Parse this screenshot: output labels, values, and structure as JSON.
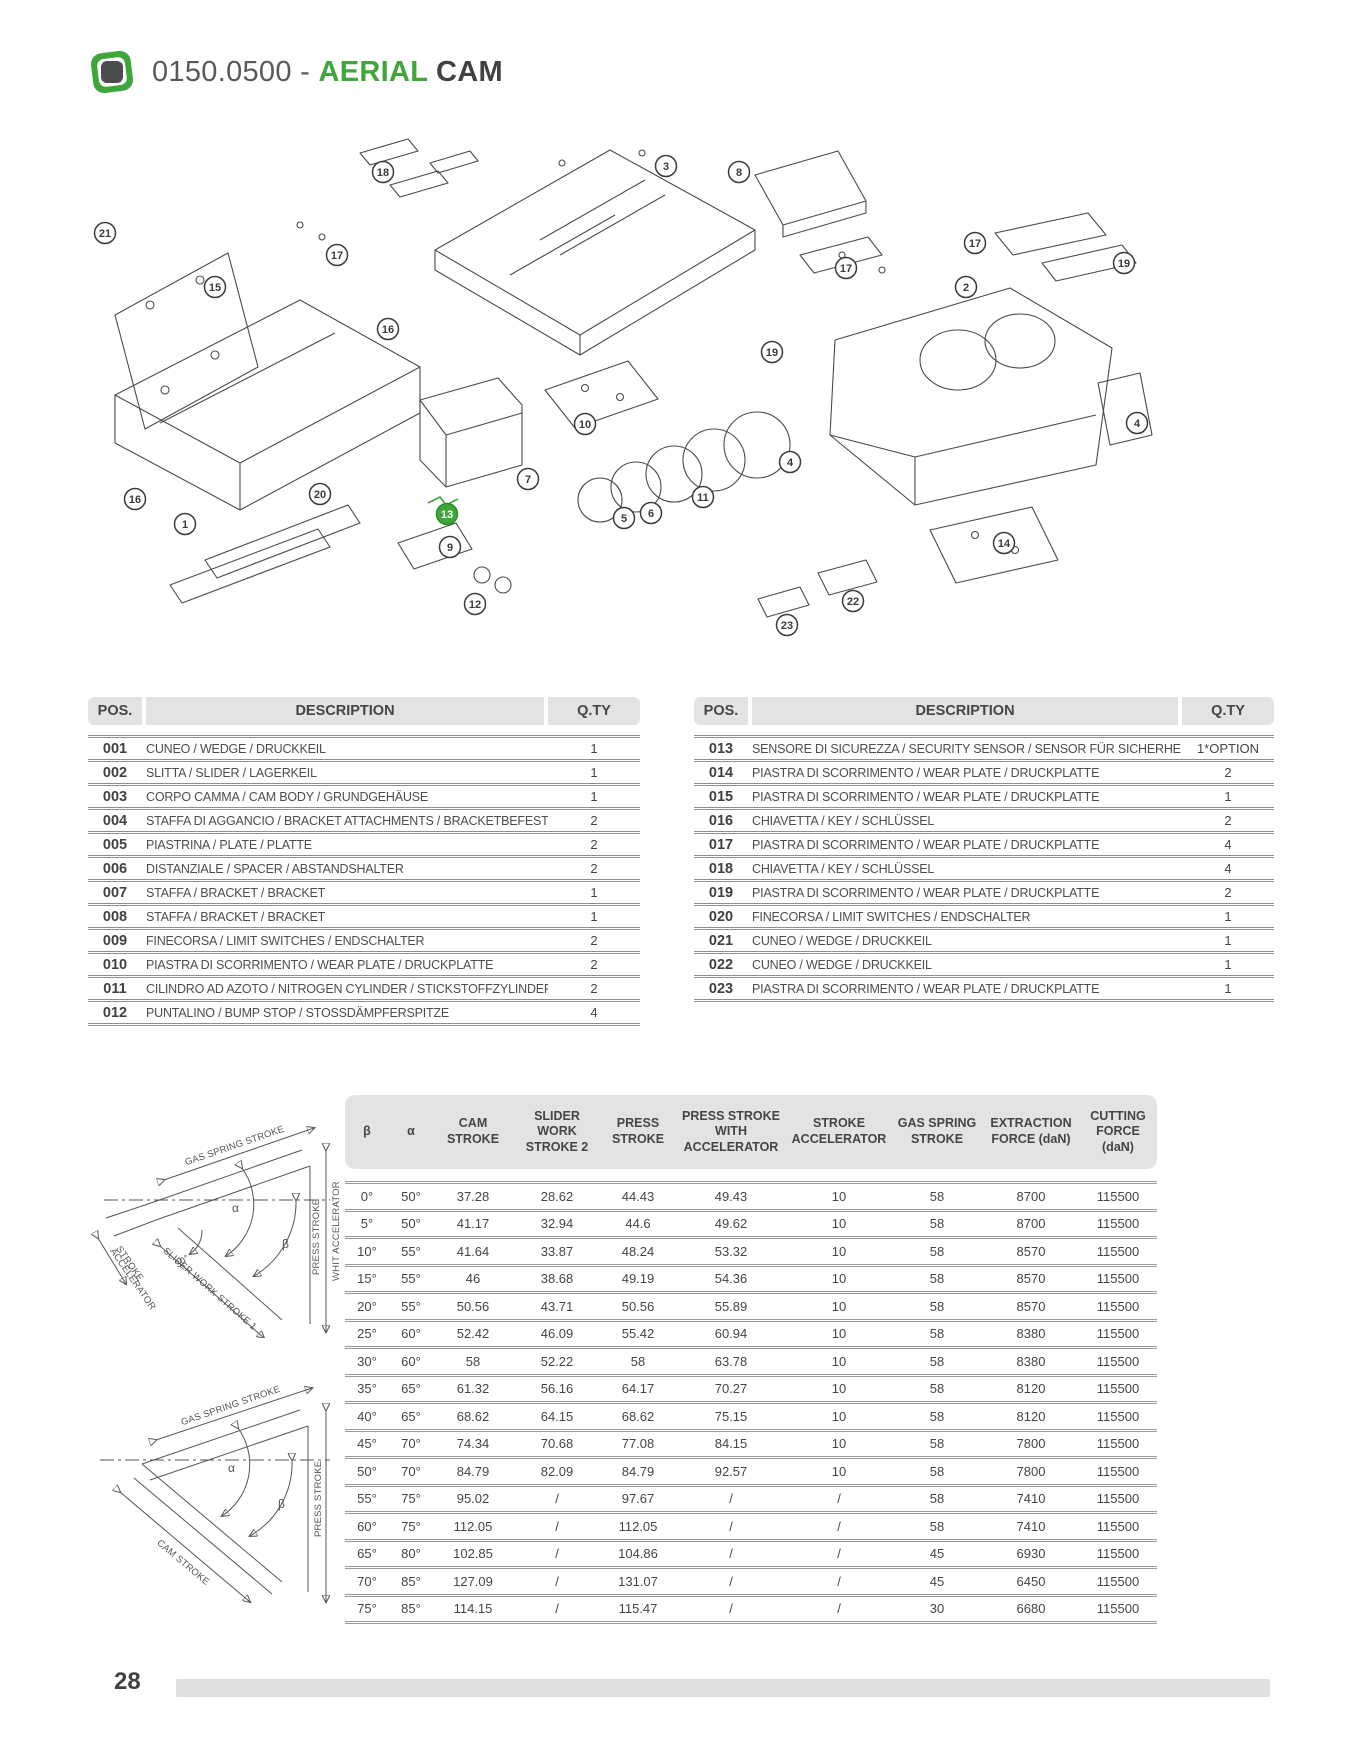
{
  "page": {
    "number": "28"
  },
  "header": {
    "code": "0150.0500 - ",
    "title_accent": "AERIAL",
    "title_rest": " CAM"
  },
  "colors": {
    "accent_green": "#3ea63b",
    "dark_text": "#414042",
    "table_header_bg": "#e3e3e3",
    "separator_line": "#8f8f8f"
  },
  "parts_table": {
    "pos_header": "POS.",
    "description_header": "DESCRIPTION",
    "qty_header": "Q.TY",
    "left_rows": [
      {
        "pos": "001",
        "description": "CUNEO / WEDGE / DRUCKKEIL",
        "qty": "1"
      },
      {
        "pos": "002",
        "description": "SLITTA / SLIDER / LAGERKEIL",
        "qty": "1"
      },
      {
        "pos": "003",
        "description": "CORPO CAMMA / CAM BODY / GRUNDGEHÄUSE",
        "qty": "1"
      },
      {
        "pos": "004",
        "description": "STAFFA DI AGGANCIO / BRACKET ATTACHMENTS / BRACKETBEFESTIGUNG",
        "qty": "2"
      },
      {
        "pos": "005",
        "description": "PIASTRINA / PLATE / PLATTE",
        "qty": "2"
      },
      {
        "pos": "006",
        "description": "DISTANZIALE / SPACER / ABSTANDSHALTER",
        "qty": "2"
      },
      {
        "pos": "007",
        "description": "STAFFA / BRACKET / BRACKET",
        "qty": "1"
      },
      {
        "pos": "008",
        "description": "STAFFA / BRACKET / BRACKET",
        "qty": "1"
      },
      {
        "pos": "009",
        "description": "FINECORSA / LIMIT SWITCHES / ENDSCHALTER",
        "qty": "2"
      },
      {
        "pos": "010",
        "description": "PIASTRA DI SCORRIMENTO / WEAR PLATE / DRUCKPLATTE",
        "qty": "2"
      },
      {
        "pos": "011",
        "description": "CILINDRO AD AZOTO / NITROGEN CYLINDER / STICKSTOFFZYLINDER",
        "qty": "2"
      },
      {
        "pos": "012",
        "description": "PUNTALINO / BUMP STOP / STOSSDÄMPFERSPITZE",
        "qty": "4"
      }
    ],
    "right_rows": [
      {
        "pos": "013",
        "description": "SENSORE DI SICUREZZA / SECURITY SENSOR / SENSOR FÜR SICHERHEIT",
        "qty": "1*OPTION"
      },
      {
        "pos": "014",
        "description": "PIASTRA DI SCORRIMENTO / WEAR PLATE / DRUCKPLATTE",
        "qty": "2"
      },
      {
        "pos": "015",
        "description": "PIASTRA DI SCORRIMENTO / WEAR PLATE / DRUCKPLATTE",
        "qty": "1"
      },
      {
        "pos": "016",
        "description": "CHIAVETTA / KEY / SCHLÜSSEL",
        "qty": "2"
      },
      {
        "pos": "017",
        "description": "PIASTRA DI SCORRIMENTO / WEAR PLATE / DRUCKPLATTE",
        "qty": "4"
      },
      {
        "pos": "018",
        "description": "CHIAVETTA / KEY / SCHLÜSSEL",
        "qty": "4"
      },
      {
        "pos": "019",
        "description": "PIASTRA DI SCORRIMENTO / WEAR PLATE / DRUCKPLATTE",
        "qty": "2"
      },
      {
        "pos": "020",
        "description": "FINECORSA / LIMIT SWITCHES / ENDSCHALTER",
        "qty": "1"
      },
      {
        "pos": "021",
        "description": "CUNEO / WEDGE / DRUCKKEIL",
        "qty": "1"
      },
      {
        "pos": "022",
        "description": "CUNEO / WEDGE / DRUCKKEIL",
        "qty": "1"
      },
      {
        "pos": "023",
        "description": "PIASTRA DI SCORRIMENTO / WEAR PLATE / DRUCKPLATTE",
        "qty": "1"
      }
    ]
  },
  "callouts": [
    {
      "label": "18",
      "x": 383,
      "y": 67
    },
    {
      "label": "3",
      "x": 666,
      "y": 61
    },
    {
      "label": "8",
      "x": 739,
      "y": 67
    },
    {
      "label": "21",
      "x": 105,
      "y": 128
    },
    {
      "label": "17",
      "x": 337,
      "y": 150
    },
    {
      "label": "15",
      "x": 215,
      "y": 182
    },
    {
      "label": "17",
      "x": 975,
      "y": 138
    },
    {
      "label": "19",
      "x": 1124,
      "y": 158
    },
    {
      "label": "17",
      "x": 846,
      "y": 163
    },
    {
      "label": "2",
      "x": 966,
      "y": 182
    },
    {
      "label": "16",
      "x": 388,
      "y": 224
    },
    {
      "label": "19",
      "x": 772,
      "y": 247
    },
    {
      "label": "10",
      "x": 585,
      "y": 319
    },
    {
      "label": "4",
      "x": 1137,
      "y": 318
    },
    {
      "label": "7",
      "x": 528,
      "y": 374
    },
    {
      "label": "4",
      "x": 790,
      "y": 357
    },
    {
      "label": "11",
      "x": 703,
      "y": 392
    },
    {
      "label": "16",
      "x": 135,
      "y": 394
    },
    {
      "label": "20",
      "x": 320,
      "y": 389
    },
    {
      "label": "1",
      "x": 185,
      "y": 419
    },
    {
      "label": "13",
      "x": 447,
      "y": 409,
      "highlight": true
    },
    {
      "label": "5",
      "x": 624,
      "y": 413
    },
    {
      "label": "6",
      "x": 651,
      "y": 408
    },
    {
      "label": "9",
      "x": 450,
      "y": 442
    },
    {
      "label": "14",
      "x": 1004,
      "y": 438
    },
    {
      "label": "12",
      "x": 475,
      "y": 499
    },
    {
      "label": "22",
      "x": 853,
      "y": 496
    },
    {
      "label": "23",
      "x": 787,
      "y": 520
    }
  ],
  "angle_diagram_top": {
    "gas_spring": "GAS SPRING STROKE",
    "stroke_accelerator_1": "STROKE",
    "stroke_accelerator_2": "ACCELERATOR",
    "slider_work": "SLIDER WORK STROKE 1",
    "press_stroke_1": "PRESS STROKE",
    "press_stroke_2": "WHIT ACCELERATOR",
    "alpha": "α",
    "beta": "β",
    "angle30": "30°"
  },
  "angle_diagram_bottom": {
    "gas_spring": "GAS SPRING STROKE",
    "cam_stroke": "CAM STROKE",
    "press_stroke": "PRESS STROKE",
    "alpha": "α",
    "beta": "β"
  },
  "spec_table": {
    "columns": [
      "β",
      "α",
      "CAM STROKE",
      "SLIDER WORK STROKE 2",
      "PRESS STROKE",
      "PRESS STROKE WITH ACCELERATOR",
      "STROKE ACCELERATOR",
      "GAS SPRING STROKE",
      "EXTRACTION FORCE (daN)",
      "CUTTING FORCE (daN)"
    ],
    "rows": [
      [
        "0°",
        "50°",
        "37.28",
        "28.62",
        "44.43",
        "49.43",
        "10",
        "58",
        "8700",
        "115500"
      ],
      [
        "5°",
        "50°",
        "41.17",
        "32.94",
        "44.6",
        "49.62",
        "10",
        "58",
        "8700",
        "115500"
      ],
      [
        "10°",
        "55°",
        "41.64",
        "33.87",
        "48.24",
        "53.32",
        "10",
        "58",
        "8570",
        "115500"
      ],
      [
        "15°",
        "55°",
        "46",
        "38.68",
        "49.19",
        "54.36",
        "10",
        "58",
        "8570",
        "115500"
      ],
      [
        "20°",
        "55°",
        "50.56",
        "43.71",
        "50.56",
        "55.89",
        "10",
        "58",
        "8570",
        "115500"
      ],
      [
        "25°",
        "60°",
        "52.42",
        "46.09",
        "55.42",
        "60.94",
        "10",
        "58",
        "8380",
        "115500"
      ],
      [
        "30°",
        "60°",
        "58",
        "52.22",
        "58",
        "63.78",
        "10",
        "58",
        "8380",
        "115500"
      ],
      [
        "35°",
        "65°",
        "61.32",
        "56.16",
        "64.17",
        "70.27",
        "10",
        "58",
        "8120",
        "115500"
      ],
      [
        "40°",
        "65°",
        "68.62",
        "64.15",
        "68.62",
        "75.15",
        "10",
        "58",
        "8120",
        "115500"
      ],
      [
        "45°",
        "70°",
        "74.34",
        "70.68",
        "77.08",
        "84.15",
        "10",
        "58",
        "7800",
        "115500"
      ],
      [
        "50°",
        "70°",
        "84.79",
        "82.09",
        "84.79",
        "92.57",
        "10",
        "58",
        "7800",
        "115500"
      ],
      [
        "55°",
        "75°",
        "95.02",
        "/",
        "97.67",
        "/",
        "/",
        "58",
        "7410",
        "115500"
      ],
      [
        "60°",
        "75°",
        "112.05",
        "/",
        "112.05",
        "/",
        "/",
        "58",
        "7410",
        "115500"
      ],
      [
        "65°",
        "80°",
        "102.85",
        "/",
        "104.86",
        "/",
        "/",
        "45",
        "6930",
        "115500"
      ],
      [
        "70°",
        "85°",
        "127.09",
        "/",
        "131.07",
        "/",
        "/",
        "45",
        "6450",
        "115500"
      ],
      [
        "75°",
        "85°",
        "114.15",
        "/",
        "115.47",
        "/",
        "/",
        "30",
        "6680",
        "115500"
      ]
    ]
  }
}
